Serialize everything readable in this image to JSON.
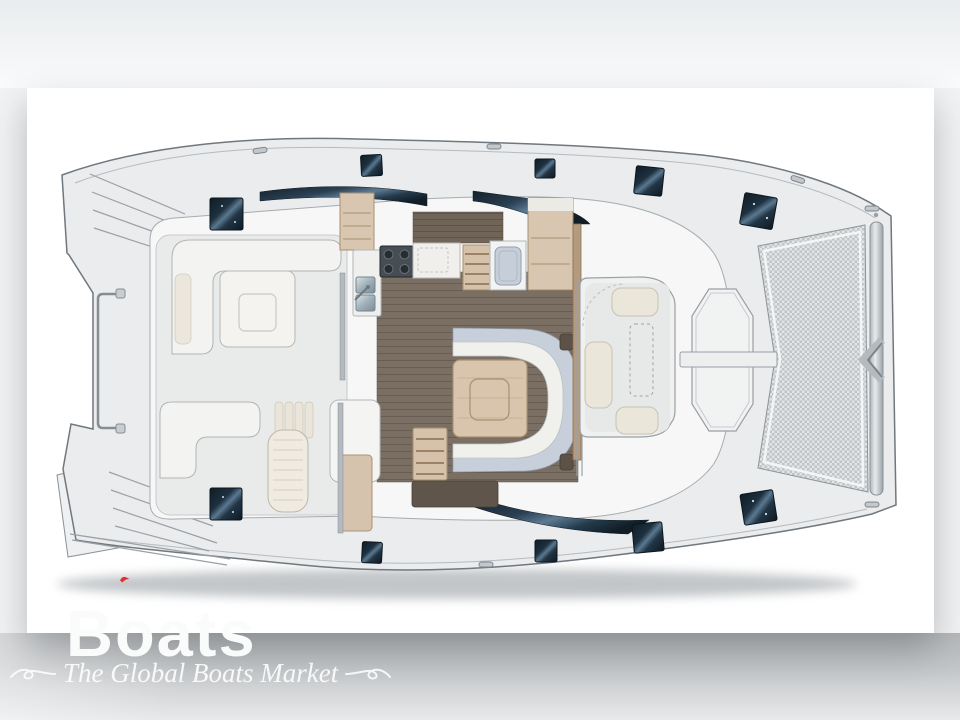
{
  "watermark": {
    "brand": "Boats",
    "tagline": "The Global Boats Market"
  },
  "palette": {
    "brand_mark_red": "#dd3330",
    "hatch_glass_navy": "#1d3140",
    "window_band_navy": "#24384a",
    "salon_floor_wood": "#7b6f64",
    "galley_counter_walnut": "#6f6457",
    "cabinet_wood_tan": "#d9c6b0",
    "table_wood_tan": "#d9c5ae",
    "cushion_cream": "#ece7dc",
    "sofa_back_blue_gray": "#c7d0da",
    "deck_gray": "#eaeced",
    "hull_white": "#f6f7f6",
    "trampoline_mesh_gray": "#bfc4c7"
  },
  "plan": {
    "type": "catamaran-deck-floor-plan",
    "orientation": "bow-right",
    "areas": [
      "port-swim-platform",
      "starboard-swim-platform",
      "stern-rail",
      "aft-cockpit",
      "cockpit-dining-table",
      "galley",
      "salon-dinette",
      "dinette-table",
      "port-companionway",
      "starboard-companionway",
      "forward-cockpit",
      "anchor-locker-platform",
      "windlass-crossbar",
      "trampoline",
      "bow-crossbeam"
    ],
    "deck_hatches": 8,
    "roof_hatches": 2
  }
}
